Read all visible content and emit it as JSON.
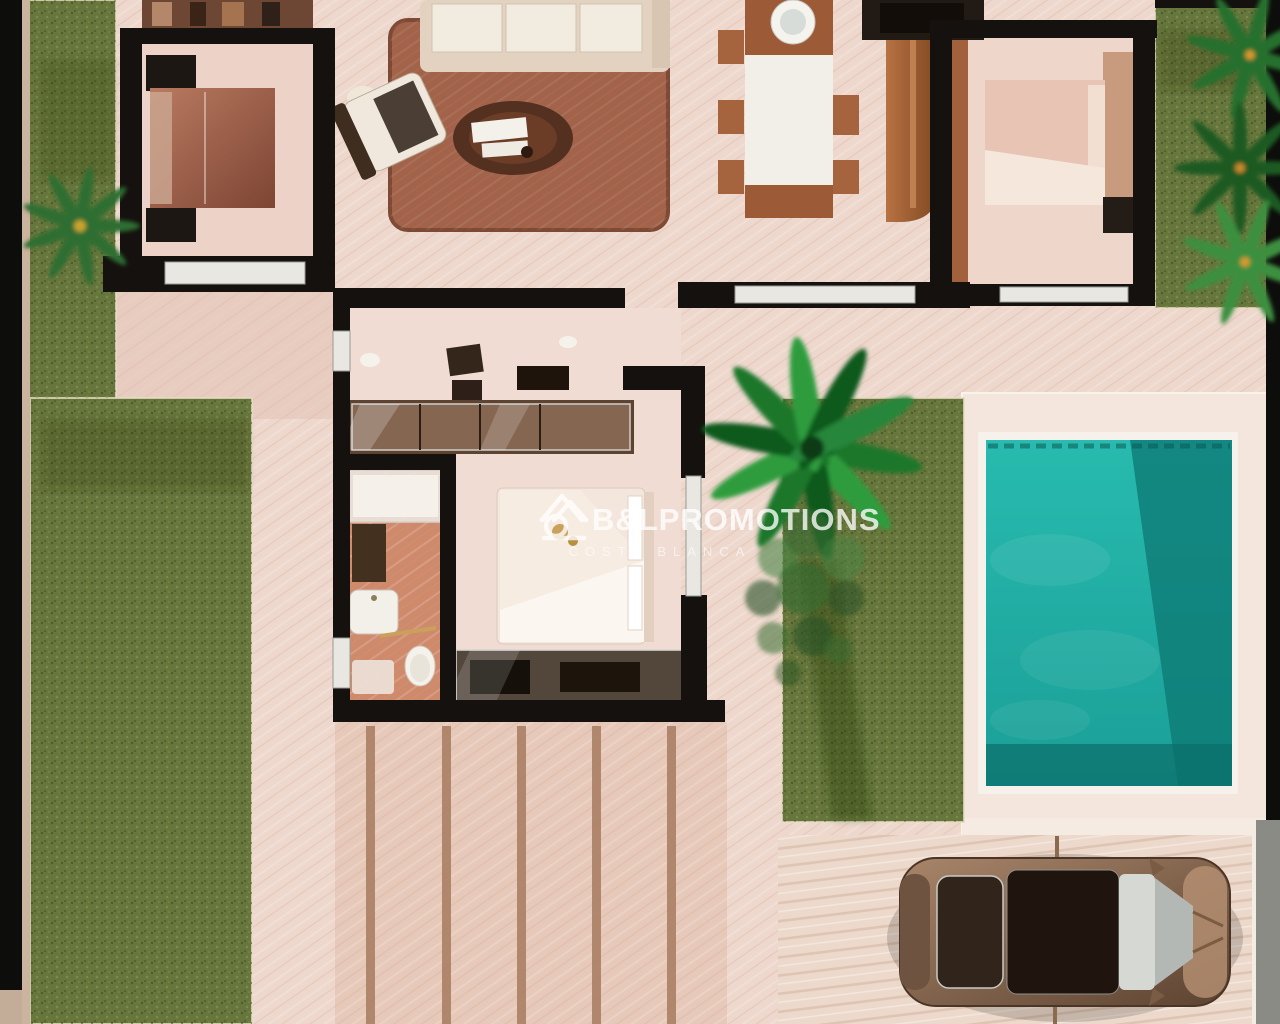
{
  "meta": {
    "description": "Top-down 3D architectural render of a villa floor plan with gardens, swimming pool, terrace and a parked car"
  },
  "watermark": {
    "brand": "B&LPROMOTIONS",
    "subtitle": "COSTA BLANCA",
    "logo": "house-logo-icon"
  },
  "colors": {
    "wall": "#14110e",
    "window": "#e9e7e2",
    "floor": "#eed8cd",
    "pool_deck": "#f4e6dc",
    "grass": "#67763c",
    "pool_water": "#23b3a8",
    "pool_deep": "#0e7a76",
    "terrace": "#e7c9ba",
    "driveway": "#ecd9cb",
    "rug": "#a2634a",
    "edge_black": "#0d0d0b",
    "edge_gray": "#8b8b86"
  },
  "scene": {
    "areas": [
      {
        "name": "left-garden"
      },
      {
        "name": "center-garden"
      },
      {
        "name": "right-garden"
      },
      {
        "name": "swimming-pool"
      },
      {
        "name": "pool-deck"
      },
      {
        "name": "driveway"
      },
      {
        "name": "rear-terrace"
      }
    ],
    "rooms": [
      {
        "name": "bedroom-top-left"
      },
      {
        "name": "living-room"
      },
      {
        "name": "dining-area"
      },
      {
        "name": "kitchen"
      },
      {
        "name": "bedroom-top-right"
      },
      {
        "name": "hallway-dressing"
      },
      {
        "name": "bathroom"
      },
      {
        "name": "master-bedroom"
      }
    ],
    "objects": [
      {
        "name": "car"
      },
      {
        "name": "palm-tree"
      },
      {
        "name": "garden-tree"
      },
      {
        "name": "sofa"
      },
      {
        "name": "armchair"
      },
      {
        "name": "coffee-table"
      },
      {
        "name": "dining-table"
      },
      {
        "name": "kitchen-island"
      },
      {
        "name": "double-bed"
      },
      {
        "name": "wardrobe"
      },
      {
        "name": "shower"
      },
      {
        "name": "toilet"
      }
    ]
  }
}
